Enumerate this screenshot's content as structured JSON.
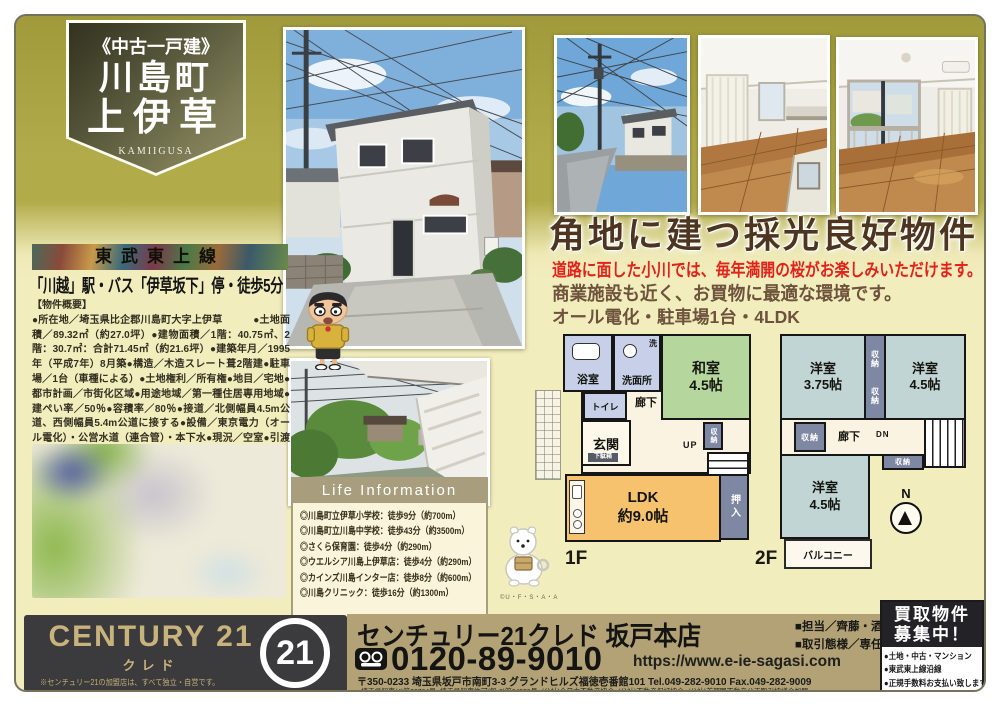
{
  "badge": {
    "category": "《中古一戸建》",
    "town": "川島町",
    "name": "上伊草",
    "romaji": "KAMIIGUSA"
  },
  "left_col": {
    "rail_line": "東武東上線",
    "access": "「川越」駅・バス「伊草坂下」停・徒歩5分",
    "outline_title": "【物件概要】",
    "outline_body": "●所在地／埼玉県比企郡川島町大字上伊草　　　●土地面積／89.32㎡（約27.0坪）●建物面積／1階：40.75㎡、2階：30.7㎡：合計71.45㎡（約21.6坪）●建築年月／1995年（平成7年）8月築●構造／木造スレート葺2階建●駐車場／1台（車種による）●土地権利／所有権●地目／宅地●都市計画／市街化区域●用途地域／第一種住居専用地域●建ぺい率／50％●容積率／80％●接道／北側幅員4.5m公道、西側幅員5.4m公道に接する●設備／東京電力（オール電化）・公営水道（連合管）・本下水●現況／空室●引渡し／相談　※契約不適合責任免責　※境界非明示",
    "outline_note": "※図面と現況が異なる場合は現況を優先とします。"
  },
  "main_copy": {
    "headline": "角地に建つ採光良好物件",
    "sub_red": "道路に面した小川では、毎年満開の桜がお楽しみいただけます。",
    "sub_brown": "商業施設も近く、お買物に最適な環境です。",
    "features": "オール電化・駐車場1台・4LDK"
  },
  "life_info": {
    "title": "Life Information",
    "items": [
      "◎川島町立伊草小学校：徒歩9分（約700m）",
      "◎川島町立川島中学校：徒歩43分（約3500m）",
      "◎さくら保育園：徒歩4分（約290m）",
      "◎ウエルシア川島上伊草店：徒歩4分（約290m）",
      "◎カインズ川島インター店：徒歩8分（約600m）",
      "◎川島クリニック：徒歩16分（約1300m）"
    ]
  },
  "mascots": {
    "dog_credit": "©U・F・S・A・A"
  },
  "floor_plan": {
    "f1": {
      "label": "1F",
      "bath": "浴室",
      "wash_mark": "洗",
      "washroom": "洗面所",
      "toilet": "トイレ",
      "entrance": "玄関",
      "shoe_box": "下駄箱",
      "hallway": "廊下",
      "up": "UP",
      "stair_storage": "収納",
      "tatami_room": "和室\n4.5帖",
      "ldk": "LDK\n約9.0帖",
      "closet": "押入"
    },
    "f2": {
      "label": "2F",
      "room_a": "洋室\n3.75帖",
      "room_b": "洋室\n4.5帖",
      "room_c": "洋室\n4.5帖",
      "storage": "収納",
      "hallway": "廊下",
      "dn": "DN",
      "balcony": "バルコニー",
      "north": "N"
    }
  },
  "footer": {
    "brand": "CENTURY 21",
    "brand_sub": "クレド",
    "brand_mark": "21",
    "brand_note": "※センチュリー21の加盟店は、すべて独立・自営です。",
    "store_name": "センチュリー21クレド 坂戸本店",
    "phone": "0120-89-9010",
    "url": "https://www.e-ie-sagasi.com",
    "address": "〒350-0233 埼玉県坂戸市南町3-3 グランドヒルズ福徳壱番館101 Tel.049-282-9010 Fax.049-282-9009",
    "licenses": "■埼玉県知事(4)第20764号■埼玉県知事許可(般-2)第64523号■(公社)全日本不動産協会■(公社)不動産保証協会■(公社)首都圏不動産公正取引協議会加盟",
    "staff": "■担当／齊藤・酒匂",
    "deal_type": "■取引態様／専任媒介",
    "kaitori": {
      "title": "買取物件\n募集中！",
      "items": [
        "●土地・中古・マンション",
        "●東武東上線沿線",
        "●正規手数料お支払い致します"
      ]
    }
  },
  "colors": {
    "olive_bg": "#b2ab4a",
    "cream_bg": "#f2edbd",
    "accent_red": "#e2231a",
    "headline_brown": "#4e3520",
    "footer_dark": "#3b3b3d",
    "footer_tan": "#b2a276",
    "brand_gold": "#c9b37c",
    "plan_tatami_green": "#b5d79e",
    "plan_ldk_orange": "#f6c26d",
    "plan_wet_blue": "#c7d0e8",
    "plan_western_teal": "#c2d5d5",
    "plan_closet_slate": "#7e88a2"
  }
}
